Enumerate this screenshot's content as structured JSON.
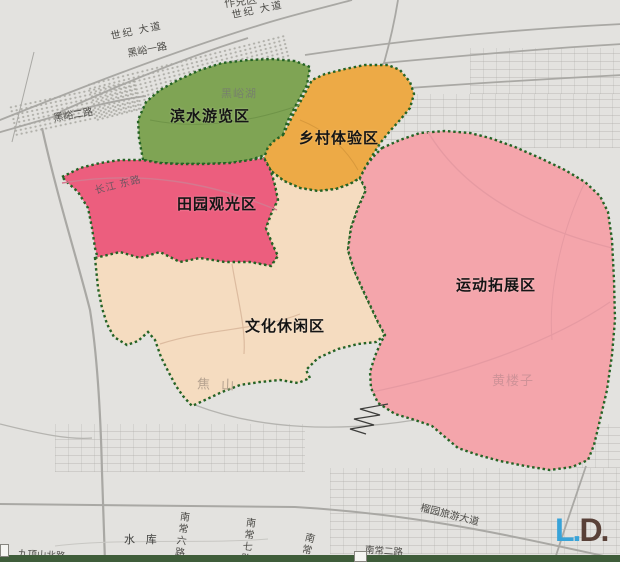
{
  "zones": {
    "waterfront": {
      "label": "滨水游览区",
      "color": "#7fa454"
    },
    "rural_experience": {
      "label": "乡村体验区",
      "color": "#edaa46"
    },
    "pastoral_sightseeing": {
      "label": "田园观光区",
      "color": "#ec5e7e"
    },
    "cultural_leisure": {
      "label": "文化休闲区",
      "color": "#f5dcc0"
    },
    "sports_expansion": {
      "label": "运动拓展区",
      "color": "#f4a5ab"
    }
  },
  "roads": {
    "century_avenue_1": "世纪 大道",
    "century_avenue_2": "世纪 大道",
    "heiyu_road_1": "黑峪一路",
    "heiyu_road_2": "黑峪二路",
    "changjiang_east": "长江 东路",
    "liuyuan_tourist_avenue": "榴园旅游大道",
    "nanchang_2nd": "南常二路",
    "nanchang_6th": "南常六路",
    "nanchang_7th": "南常七路",
    "nanchang_partial": "南常",
    "jiudingshan_north": "九顶山北路"
  },
  "places": {
    "heiyu_lake": "黑峪湖",
    "jiao_mountain": "焦 山",
    "huanglouzi": "黄楼子",
    "reservoir": "水 库",
    "top_edge_partial": "作兑区"
  },
  "logo": {
    "part1": "L.",
    "part2": "D.",
    "part1_color": "#38a3d8",
    "part2_color": "#594138"
  },
  "colors": {
    "background": "#e3e2df",
    "zone_border": "#256325",
    "road_line": "#a9a8a4",
    "bottom_bar": "#3f5d3a"
  }
}
